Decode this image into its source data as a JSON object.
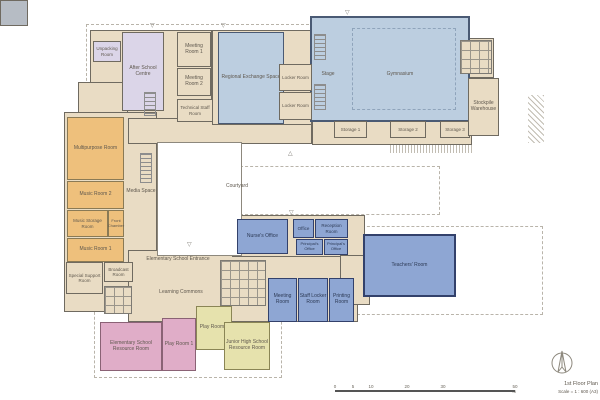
{
  "title_block": {
    "title": "1st Floor Plan",
    "scale": "Scale = 1 : 600 (A3)"
  },
  "scale_bar": {
    "ticks": [
      "0",
      "5",
      "10",
      "20",
      "30",
      "50 m"
    ]
  },
  "colors": {
    "circulation_tan": "#e9dcc4",
    "hall_light_blue": "#bccee0",
    "after_school_lavender": "#dbd5e8",
    "music_orange": "#eec07c",
    "admin_blue": "#8ea6d3",
    "elementary_pink": "#e0adc8",
    "junior_high_green": "#e6e2ad",
    "core_gray": "#b6bcc4",
    "wall": "#4a4a4a"
  },
  "rooms": {
    "unpacking": {
      "label": "Unpacking Room"
    },
    "after_school": {
      "label": "After School Centre"
    },
    "meeting1": {
      "label": "Meeting Room 1"
    },
    "meeting2": {
      "label": "Meeting Room 2"
    },
    "tech_staff": {
      "label": "Technical Staff Room"
    },
    "regional_exchange": {
      "label": "Regional Exchange Space"
    },
    "stage": {
      "label": "Stage"
    },
    "gymnasium": {
      "label": "Gymnasium"
    },
    "locker_a": {
      "label": "Locker Room"
    },
    "locker_b": {
      "label": "Locker Room"
    },
    "storage1": {
      "label": "Storage 1"
    },
    "storage2": {
      "label": "Storage 2"
    },
    "storage3": {
      "label": "Storage 3"
    },
    "stockpile": {
      "label": "Stockpile Warehouse"
    },
    "multipurpose": {
      "label": "Multipurpose Room"
    },
    "music2": {
      "label": "Music Room 2"
    },
    "music_storage": {
      "label": "Music Storage Room"
    },
    "front_chamber": {
      "label": "Front Chamber"
    },
    "music1": {
      "label": "Music Room 1"
    },
    "media_space": {
      "label": "Media Space"
    },
    "special_support": {
      "label": "Special Support Room"
    },
    "broadcast": {
      "label": "Broadcast Room"
    },
    "courtyard": {
      "label": "Courtyard"
    },
    "entrance": {
      "label": "Elementary School Entrance"
    },
    "learning_commons": {
      "label": "Learning Commons"
    },
    "nurses_office": {
      "label": "Nurse's Office"
    },
    "office": {
      "label": "Office"
    },
    "reception": {
      "label": "Reception Room"
    },
    "principal1": {
      "label": "Principal's Office"
    },
    "principal2": {
      "label": "Principal's Office"
    },
    "teachers_room": {
      "label": "Teachers' Room"
    },
    "meeting_room": {
      "label": "Meeting Room"
    },
    "staff_locker": {
      "label": "Staff Locker Room"
    },
    "printing": {
      "label": "Printing Room"
    },
    "elem_resource": {
      "label": "Elementary School Resource Room"
    },
    "play1": {
      "label": "Play Room 1"
    },
    "play2": {
      "label": "Play Room 2"
    },
    "jhs_resource": {
      "label": "Junior High School Resource Room"
    }
  }
}
